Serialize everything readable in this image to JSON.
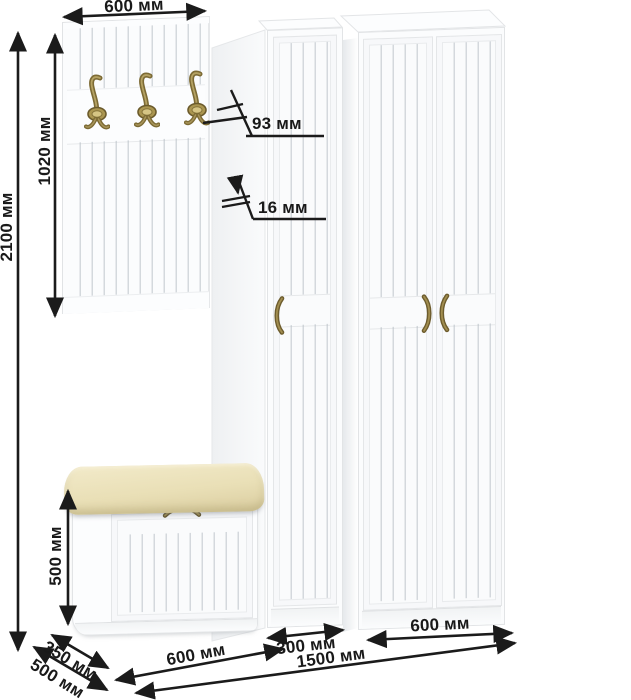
{
  "units": "мм",
  "labels": {
    "panel_width": "600 мм",
    "panel_height": "1020 мм",
    "total_height": "2100 мм",
    "hook_height": "93 мм",
    "panel_thickness": "16 мм",
    "bench_height": "500 мм",
    "bench_depth": "350 мм",
    "cabinet_depth": "500 мм",
    "bench_width": "600 мм",
    "narrow_cabinet_width": "300 мм",
    "wide_cabinet_width": "600 мм",
    "total_width": "1500 мм"
  },
  "colors": {
    "furniture_white": "#fbfcfd",
    "groove_gray": "#dfe2e5",
    "cushion_cream": "#e9dfb6",
    "brass": "#8a783e",
    "dimension_ink": "#1b1b1b"
  },
  "icons": {
    "coat_hook": "coat-hook-icon",
    "door_handle": "door-handle-icon",
    "bench_handle": "bench-handle-icon",
    "dimension_arrow": "dimension-arrow"
  }
}
